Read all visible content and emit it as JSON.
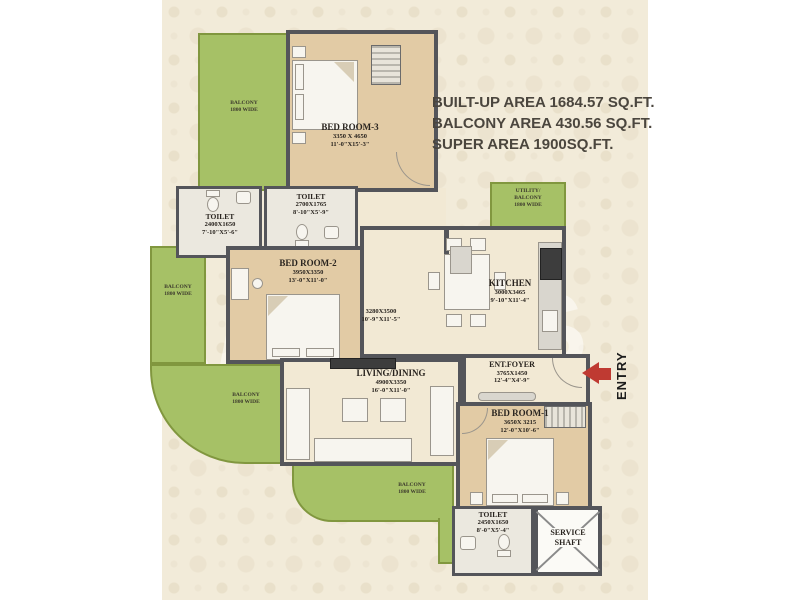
{
  "area_summary": {
    "line1": "BUILT-UP AREA 1684.57 SQ.FT.",
    "line2": "BALCONY AREA 430.56 SQ.FT.",
    "line3": "SUPER AREA 1900SQ.FT."
  },
  "entry": {
    "label": "ENTRY",
    "arrow_color": "#bf3a32"
  },
  "watermark": "MORES",
  "rooms": {
    "bedroom3": {
      "name": "BED ROOM-3",
      "mm": "3350 X 4650",
      "ft": "11'-0\"X15'-3\""
    },
    "toilet_a": {
      "name": "TOILET",
      "mm": "2400X1650",
      "ft": "7'-10\"X5'-6\""
    },
    "toilet_b": {
      "name": "TOILET",
      "mm": "2700X1765",
      "ft": "8'-10\"X5'-9\""
    },
    "bedroom2": {
      "name": "BED ROOM-2",
      "mm": "3950X3350",
      "ft": "13'-0\"X11'-0\""
    },
    "hall": {
      "mm": "3280X3500",
      "ft": "10'-9\"X11'-5\""
    },
    "kitchen": {
      "name": "KITCHEN",
      "mm": "3000X3465",
      "ft": "9'-10\"X11'-4\""
    },
    "living": {
      "name": "LIVING/DINING",
      "mm": "4900X3350",
      "ft": "16'-0\"X11'-0\""
    },
    "foyer": {
      "name": "ENT.FOYER",
      "mm": "3765X1450",
      "ft": "12'-4\"X4'-9\""
    },
    "bedroom1": {
      "name": "BED ROOM-1",
      "mm": "3650X 3215",
      "ft": "12'-0\"X10'-6\""
    },
    "toilet_c": {
      "name": "TOILET",
      "mm": "2450X1650",
      "ft": "8'-0\"X5'-4\""
    },
    "service": {
      "line1": "SERVICE",
      "line2": "SHAFT"
    }
  },
  "balconies": {
    "label_line1": "BALCONY",
    "label_line2": "1800 WIDE",
    "utility_line1": "UTILITY/",
    "utility_line2": "BALCONY",
    "utility_line3": "1800 WIDE"
  },
  "colors": {
    "balcony_green": "#a6c166",
    "wall": "#54555a",
    "wood_floor": "#e2cba5",
    "plan_floor": "#f2e9d4",
    "entry_arrow": "#bf3a32"
  }
}
